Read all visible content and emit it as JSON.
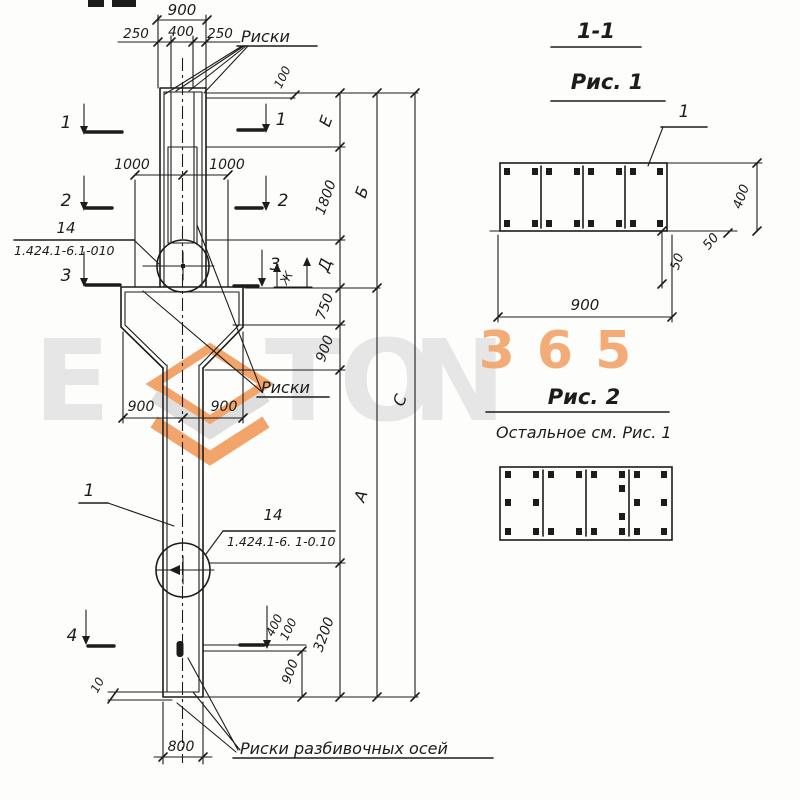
{
  "colors": {
    "ink": "#1c1c1c",
    "watermark_orange": "#f2a46a",
    "watermark_gray_letters": "#e6e6e6",
    "watermark_gray_chevron": "#dedede",
    "paper": "#fdfdfb"
  },
  "top": {
    "d900": "900",
    "d250l": "250",
    "d400": "400",
    "d250r": "250",
    "riski": "Риски",
    "d100": "100"
  },
  "sections": {
    "s1": "1",
    "s2": "2",
    "s3": "3",
    "s4": "4",
    "zh": "Ж",
    "d400b": "400",
    "d100b": "100"
  },
  "mid": {
    "d1000l": "1000",
    "d1000r": "1000",
    "callout_pos": "14",
    "callout_ref": "1.424.1-6.1-010",
    "riski": "Риски",
    "d900l": "900",
    "d900r": "900",
    "pos1": "1"
  },
  "lower": {
    "callout_pos": "14",
    "callout_ref": "1.424.1-6. 1-0.10"
  },
  "right_chain": {
    "E": "Е",
    "d1800": "1800",
    "D": "Д",
    "d750": "750",
    "d900": "900",
    "B": "Б",
    "C": "С",
    "A": "А",
    "d3200": "3200",
    "d900b": "900"
  },
  "bottom": {
    "d10": "10",
    "d800": "800",
    "riski_axes": "Риски разбивочных осей"
  },
  "fig1": {
    "title": "1-1",
    "caption": "Рис. 1",
    "pos1": "1",
    "d400": "400",
    "d50a": "50",
    "d50b": "50",
    "d900": "900"
  },
  "fig2": {
    "caption": "Рис. 2",
    "note": "Остальное см. Рис. 1"
  },
  "watermark": {
    "digits": "365",
    "l1": "E",
    "l2": "T",
    "l3": "O",
    "l4": "N"
  }
}
